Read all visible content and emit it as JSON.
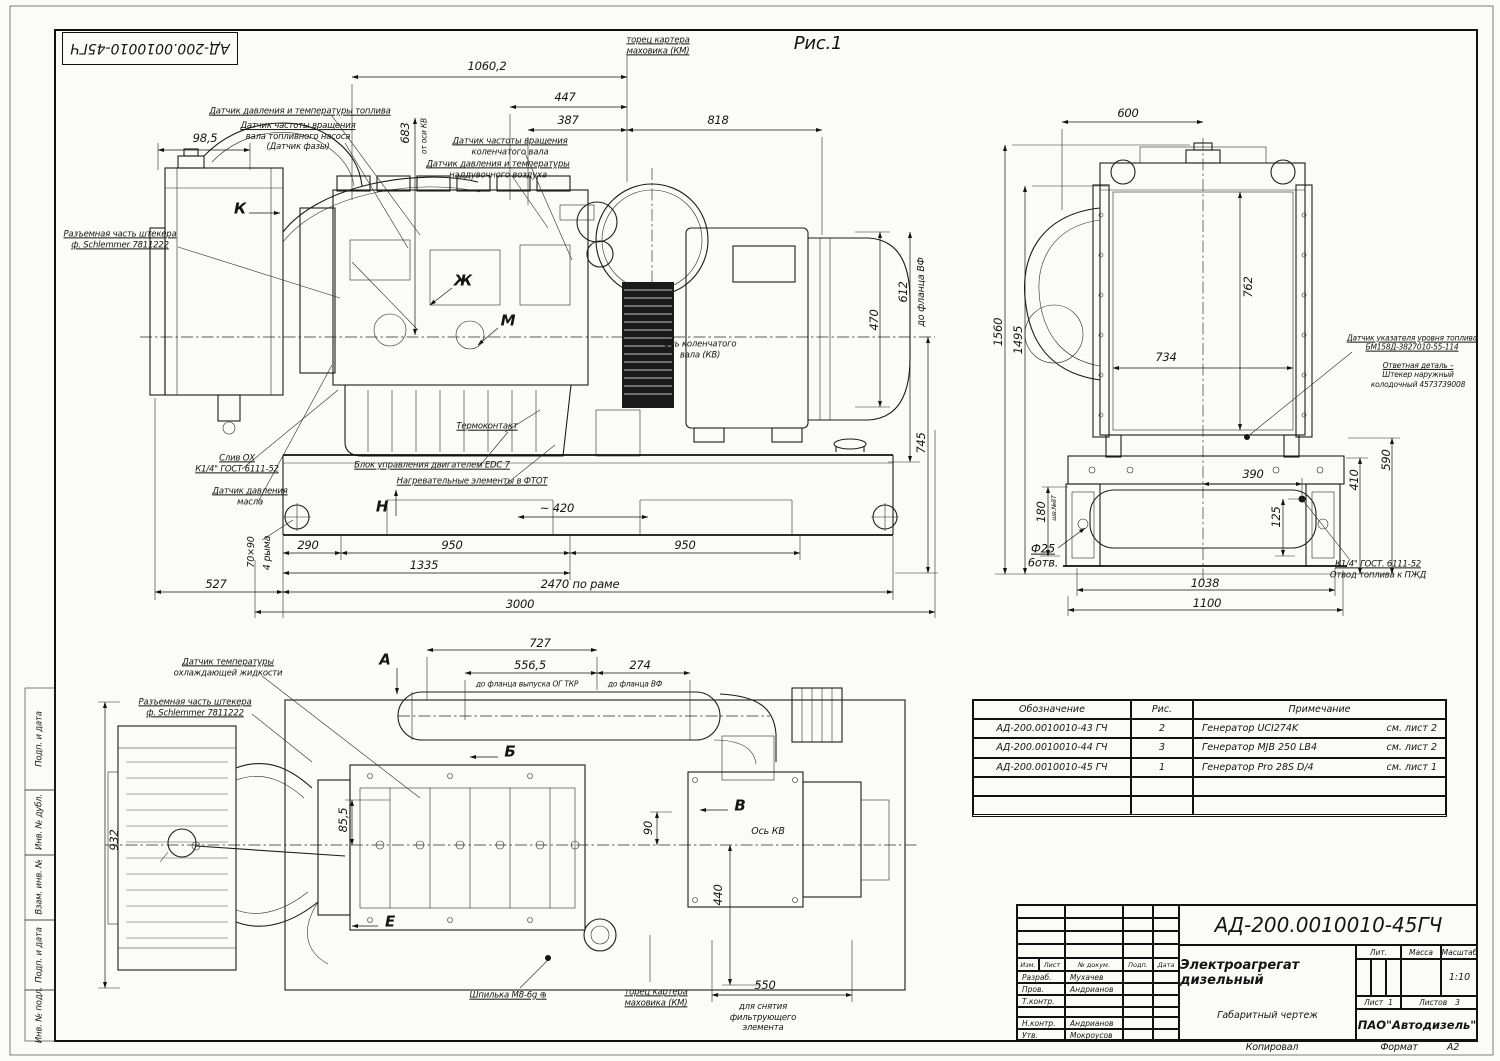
{
  "sheet": {
    "corner_stamp": "АД-200.0010010-45ГЧ",
    "figure_label": "Рис.1",
    "footer_copied": "Копировал",
    "footer_format": "Формат",
    "footer_format_value": "А2"
  },
  "margin": {
    "m1": "Подп. и дата",
    "m2": "Инв. № дубл.",
    "m3": "Взам. инв. №",
    "m4": "Подп. и дата",
    "m5": "Инв. № подл."
  },
  "sv": {
    "kmface1": "торец картера",
    "kmface2": "маховика (КМ)",
    "d1060": "1060,2",
    "d447": "447",
    "d387": "387",
    "d818": "818",
    "d683": "683",
    "d683n": "от оси КВ",
    "d985": "98,5",
    "fuel": "Датчик давления и температуры топлива",
    "phase1": "Датчик частоты вращения",
    "phase2": "вала топливного насоса",
    "phase3": "(Датчик фазы)",
    "crank1": "Датчик частоты вращения",
    "crank2": "коленчатого вала",
    "boost1": "Датчик давления и температуры",
    "boost2": "наддувочного воздуха",
    "plug1": "Разъемная часть штекера",
    "plug2": "ф. Schlemmer 7811222",
    "k": "К",
    "zh": "Ж",
    "m": "М",
    "h": "Н",
    "drain1": "Слив ОХ",
    "drain2": "К1/4\" ГОСТ 6111-52",
    "oil1": "Датчик давления",
    "oil2": "масла",
    "edc": "Блок управления двигателем EDC 7",
    "heat": "Нагревательные элементы в ФТОТ",
    "thermo": "Термоконтакт",
    "axis1": "Ось коленчатого",
    "axis2": "вала (КВ)",
    "d470": "470",
    "d612": "612",
    "d612n": "до фланца ВФ",
    "d745": "745",
    "d420": "~ 420",
    "d290": "290",
    "d950a": "950",
    "d950b": "950",
    "d1335": "1335",
    "d2470": "2470 по раме",
    "d527": "527",
    "d3000": "3000",
    "d7090": "70×90",
    "ryma": "4 рыма"
  },
  "fv": {
    "d600": "600",
    "d1560": "1560",
    "d1495": "1495",
    "d762": "762",
    "d734": "734",
    "level1": "Датчик указателя уровня топлива",
    "level2": "БМ158Д-3827010-55-114",
    "mate1": "Ответная деталь –",
    "mate2": "Штекер наружный",
    "mate3": "колодочный 4573739008",
    "d590": "590",
    "d410": "410",
    "d390": "390",
    "d125": "125",
    "d180": "180",
    "d180n": "шв.№8Т",
    "f25a": "Ф25",
    "f25b": "6отв.",
    "d1038": "1038",
    "d1100": "1100",
    "fuelout1": "К1/4\" ГОСТ. 6111-52",
    "fuelout2": "Отвод топлива к ПЖД"
  },
  "pv": {
    "d727": "727",
    "a": "А",
    "d556": "556,5",
    "d556n": "до фланца выпуска ОГ ТКР",
    "d274": "274",
    "d274n": "до фланца ВФ",
    "cool1": "Датчик температуры",
    "cool2": "охлаждающей жидкости",
    "plug1": "Разъемная часть штекера",
    "plug2": "ф. Schlemmer 7811222",
    "b": "Б",
    "v": "В",
    "e": "Е",
    "axis": "Ось КВ",
    "d90": "90",
    "d440": "440",
    "d85": "85,5",
    "d932": "932",
    "stud": "Шпилька М8-6g ⊕",
    "km1": "торец картера",
    "km2": "маховика (КМ)",
    "d550": "550",
    "filt1": "для снятия",
    "filt2": "фильтрующего",
    "filt3": "элемента"
  },
  "parts_table": {
    "headers": {
      "designation": "Обозначение",
      "fig": "Рис.",
      "note": "Примечание"
    },
    "rows": [
      {
        "designation": "АД-200.0010010-43 ГЧ",
        "fig": "2",
        "note": "Генератор UCI274K",
        "see": "см. лист 2"
      },
      {
        "designation": "АД-200.0010010-44 ГЧ",
        "fig": "3",
        "note": "Генератор MJB 250 LB4",
        "see": "см. лист 2"
      },
      {
        "designation": "АД-200.0010010-45 ГЧ",
        "fig": "1",
        "note": "Генератор Pro 28S D/4",
        "see": "см. лист 1"
      },
      {
        "designation": "",
        "fig": "",
        "note": "",
        "see": ""
      },
      {
        "designation": "",
        "fig": "",
        "note": "",
        "see": ""
      }
    ]
  },
  "title_block": {
    "doc_number": "АД-200.0010010-45ГЧ",
    "col_izm": "Изм.",
    "col_list": "Лист",
    "col_ndoc": "№ докум.",
    "col_podp": "Подп.",
    "col_data": "Дата",
    "razrab": "Разраб.",
    "razrab_name": "Мухачев",
    "prov": "Пров.",
    "prov_name": "Андрианов",
    "tkontr": "Т.контр.",
    "tkontr_name": "",
    "nkontr": "Н.контр.",
    "nkontr_name": "Андрианов",
    "utv": "Утв.",
    "utv_name": "Мокроусов",
    "title": "Электроагрегат дизельный",
    "subtitle": "Габаритный чертеж",
    "lit": "Лит.",
    "massa": "Масса",
    "masshtab": "Масштаб",
    "scale": "1:10",
    "list_label": "Лист",
    "list_no": "1",
    "listov_label": "Листов",
    "listov_no": "3",
    "company": "ПАО\"Автодизель\""
  }
}
